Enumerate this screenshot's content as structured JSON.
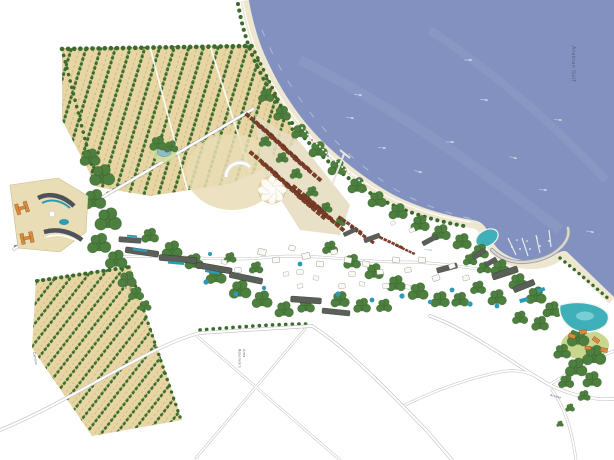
{
  "map": {
    "description": "Coastal resort master plan rendering with orchard field strips, beach, marina and road network",
    "labels": {
      "water_body": "Arabian Gulf",
      "reservoir": [
        "Area",
        "Reservoirs"
      ],
      "orchard_fields": [
        "Zona de",
        "Cultivo"
      ],
      "west_road": "Camino",
      "access_road": "Acceso"
    },
    "features": [
      "sea",
      "beach promenade",
      "marina breakwater with docks and boats",
      "orchard field strips north",
      "orchard field strips southwest",
      "red-roof townhouse rows",
      "resort village buildings",
      "apartment slab blocks",
      "swimming pools and lagoon",
      "tree clusters",
      "road network",
      "reservoir triangle parcel",
      "flower-shaped plaza",
      "pier",
      "hillside villas"
    ]
  },
  "colors": {
    "sea": "#8291bf",
    "sea_streak": "#98a6cc",
    "sand": "#efe6cf",
    "orchard": "#e7d6a4",
    "plaza": "#e9ddb6",
    "lawn": "#c5d488",
    "tree_dark": "#3c6b2f",
    "tree_mid": "#4d7f3e",
    "roof_red": "#7e3d27",
    "roof_orange": "#d98a3a",
    "pool": "#2e9bb5",
    "lagoon": "#3fb0ba",
    "slab": "#5a6058",
    "road_surface": "#ffffff",
    "road_casing": "#bfbfbf",
    "label_ink": "#6c6c64",
    "water_ink": "#555b70"
  }
}
